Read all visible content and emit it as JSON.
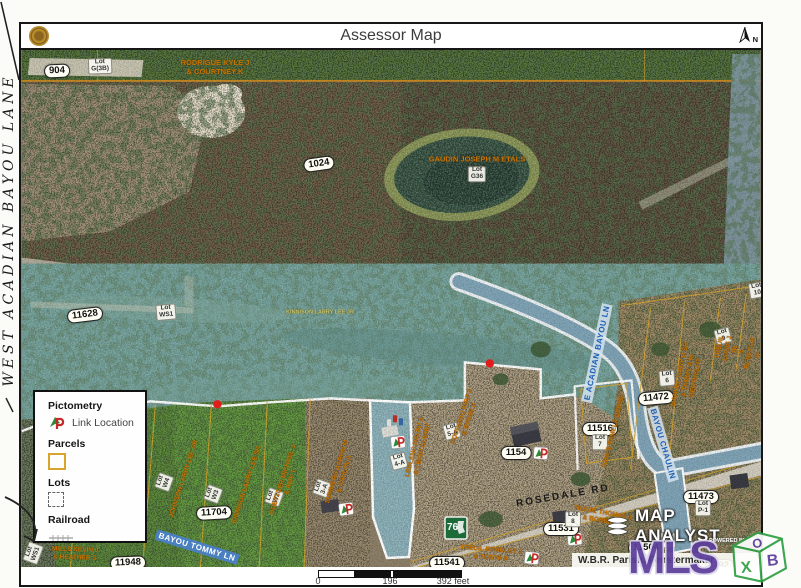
{
  "page": {
    "title": "Assessor Map"
  },
  "margin": {
    "handwritten_road": "WEST ACADIAN BAYOU LANE"
  },
  "compass": {
    "label": "N"
  },
  "legend": {
    "pictometry": "Pictometry",
    "link_location": "Link Location",
    "parcels": "Parcels",
    "lots": "Lots",
    "railroad": "Railroad"
  },
  "scalebar": {
    "zero": "0",
    "mid": "196",
    "end": "392 feet"
  },
  "branding": {
    "map_analyst": "MAP ANALYST",
    "powered_by": "POWERED BY",
    "watermark": "MLS",
    "cube": {
      "top": "O",
      "right": "B",
      "front": "X"
    }
  },
  "attribution": {
    "text": "W.B.R. Parish, Fenstermaker"
  },
  "shield": {
    "route": "76"
  },
  "roads": {
    "rosedale": "ROSEDALE RD",
    "bayou_tommy": "BAYOU TOMMY LN",
    "e_acadian": "E ACADIAN BAYOU LN",
    "bayou_chaulin": "BAYOU CHAULIN"
  },
  "parcels": [
    {
      "id": "904"
    },
    {
      "id": "1024"
    },
    {
      "id": "11628"
    },
    {
      "id": "11704"
    },
    {
      "id": "11948"
    },
    {
      "id": "11541"
    },
    {
      "id": "1154"
    },
    {
      "id": "11531"
    },
    {
      "id": "11504"
    },
    {
      "id": "11516"
    },
    {
      "id": "11472"
    },
    {
      "id": "11473"
    },
    {
      "id": "11492"
    }
  ],
  "lots": [
    {
      "prefix": "Lot",
      "value": "G(3B)"
    },
    {
      "prefix": "Lot",
      "value": "G36"
    },
    {
      "prefix": "Lot",
      "value": "WS1"
    },
    {
      "prefix": "Lot",
      "value": "W4"
    },
    {
      "prefix": "Lot",
      "value": "W3"
    },
    {
      "prefix": "Lot",
      "value": "W2"
    },
    {
      "prefix": "Lot",
      "value": "3-A"
    },
    {
      "prefix": "Lot",
      "value": "4-A"
    },
    {
      "prefix": "Lot",
      "value": "5-A"
    },
    {
      "prefix": "Lot",
      "value": "7"
    },
    {
      "prefix": "Lot",
      "value": "6"
    },
    {
      "prefix": "Lot",
      "value": "9"
    },
    {
      "prefix": "Lot",
      "value": "10"
    },
    {
      "prefix": "Lot",
      "value": "8"
    },
    {
      "prefix": "Lot",
      "value": "2"
    },
    {
      "prefix": "Lot",
      "value": "P-1"
    },
    {
      "prefix": "Lot",
      "value": "WS1"
    }
  ],
  "owners": [
    {
      "name": "RODRIGUE KYLE J\n& COURTNEY K"
    },
    {
      "name": "GAUDIN JOSEPH M ETALS"
    },
    {
      "name": "KINNISON LARRY LEE JR"
    },
    {
      "name": "JOHNSON LARRY LEE SR"
    },
    {
      "name": "KINNISON LARRY LEE SR"
    },
    {
      "name": "BOETTGER MICHAEL J\n& AMY T"
    },
    {
      "name": "SUMMERS AARON M\n& ASHLYN A"
    },
    {
      "name": "LEBLANC RALPH A\n& LEIGH GUIDRY"
    },
    {
      "name": "POURCIAU KIRT J\n& ROBIN S"
    },
    {
      "name": "JONES PAMELA DENISE"
    },
    {
      "name": "MANUEL GARY D SR\n& TAMMY A M BERTHELOT"
    },
    {
      "name": "TREUIL LOUIS J JR\n& REBECCA G"
    },
    {
      "name": "TREUIL THOMAS J\n& BOBBIE S"
    },
    {
      "name": "TREUIL BRADLEY J\n& TONYA S"
    },
    {
      "name": "MILLS KEVIN J\n& HEATHER S"
    }
  ],
  "icons": {
    "north_arrow": "north-arrow-icon",
    "seal": "parish-seal-icon",
    "pictometry_logo": "pictometry-p-icon",
    "link_marker": "pictometry-link-marker-icon",
    "link_dot": "link-location-dot",
    "map_analyst_logo": "wave-layers-icon",
    "powered_dot": "esri-globe-icon",
    "railroad_symbol": "railroad-tick-icon",
    "parcel_swatch": "parcel-outline-swatch",
    "lot_swatch": "lot-dashed-swatch",
    "watermark_cube": "mls-box-cube-icon"
  },
  "colors": {
    "floodway_teal": "#6d9a94",
    "field_green": "#5d8a3c",
    "dirt_tan": "#a39476",
    "water_blue": "#7fa3b5",
    "parcel_line_yellow": "#d8a52c",
    "boundary_white": "#ffffff",
    "owner_text_orange": "#c87400",
    "road_label_blue": "#4a80c0",
    "watermark_purple": "#5c3e9a",
    "shield_green": "#1e6b3a",
    "marker_red": "#c62828",
    "marker_green": "#2a8a3a"
  }
}
